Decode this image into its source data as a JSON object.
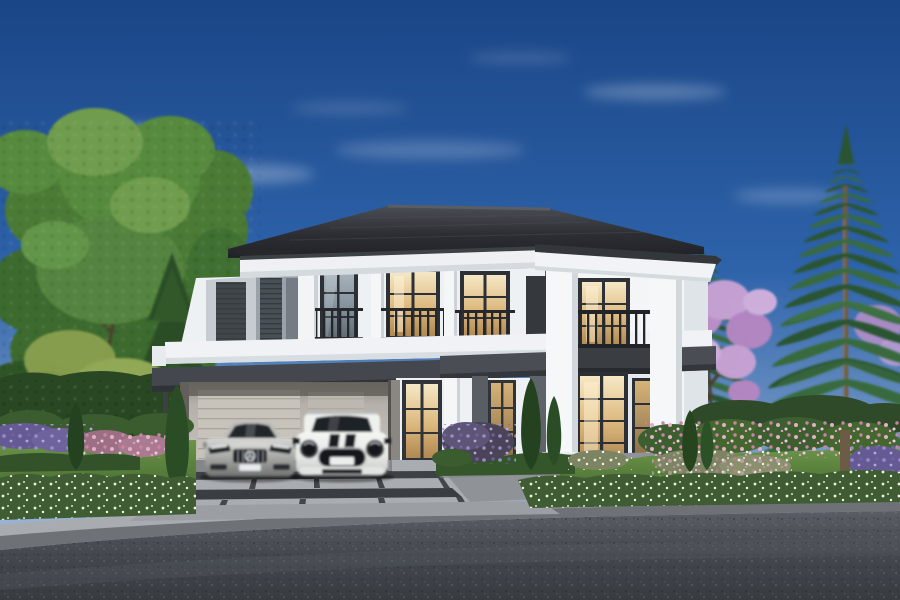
{
  "scene": {
    "alt_text": "Photorealistic exterior rendering of a luxury two-storey white house with a dark grey hip roof, juliet balconies, a carport sheltering a silver sedan and a white SUV with black bonnet stripes, landscaped flower gardens, tall pine trees and a paved street in the foreground",
    "type": "architectural-exterior-render",
    "time_of_day": "day",
    "objects": {
      "house": "two-storey modern colonial house",
      "vehicles": [
        "silver luxury sedan",
        "white compact SUV with black bonnet stripes"
      ],
      "trees": [
        "large deciduous tree",
        "spruce",
        "two norfolk pines",
        "pink flowering tree",
        "slim cypresses"
      ],
      "garden": [
        "boxwood hedges",
        "white flower hedge",
        "pink rose bushes",
        "purple flower bed",
        "lawn"
      ],
      "hardscape": [
        "paver driveway",
        "walkway",
        "entrance steps",
        "kerb",
        "asphalt road"
      ]
    },
    "palette": {
      "sky_top": "#1a4586",
      "sky_horizon": "#bad0e5",
      "wall_white": "#f1f4f6",
      "roof_dark": "#24262b",
      "trim_dark": "#3a3e44",
      "glass_warm": "#f4e3bd",
      "glass_cool": "#9fadb6",
      "foliage_green": "#417030",
      "pine_green": "#2c5530",
      "blossom_pink": "#c79fd0",
      "flower_pink": "#d795b2",
      "flower_purple": "#7e72b4",
      "lawn_green": "#5d8640",
      "driveway_grey": "#a9adb1",
      "road_grey": "#43464c",
      "car_silver": "#a8a9a7",
      "car_white": "#edefed"
    }
  }
}
